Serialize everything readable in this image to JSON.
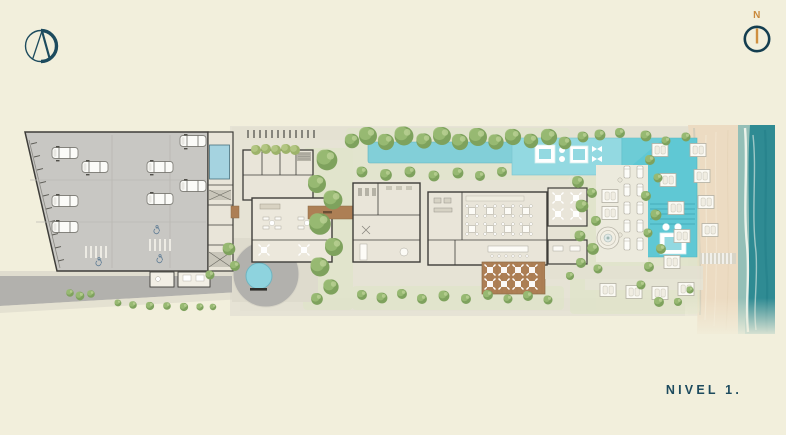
{
  "window": {
    "background_color": "#f2efdc"
  },
  "brand": {
    "monogram_letter": "A",
    "description": "circle-A-monogram-logo",
    "color": "#1d4b5e"
  },
  "compass": {
    "north_label": "N",
    "label_color": "#c9893b",
    "ring_color": "#143e50",
    "needle_color": "#cf8f3f"
  },
  "plan": {
    "level_label": "NIVEL 1.",
    "level_label_color": "#1d4b5e",
    "features": [
      "parking-garage",
      "access-road",
      "guard-house",
      "drop-off-court",
      "reflecting-pond",
      "lobby-building",
      "wellness-gym-building",
      "restaurant-building",
      "lounge-pavilions",
      "wood-dining-deck",
      "entry-bridge",
      "lap-pool",
      "family-pool",
      "main-pool",
      "pool-deck",
      "sun-loungers",
      "fountain",
      "gardens",
      "beach-cabanas",
      "boardwalk",
      "beach-sand",
      "ocean"
    ]
  },
  "palette": {
    "background": "#f2efdc",
    "navy": "#1d4b5e",
    "accent_orange": "#c9893b",
    "pool_teal": "#5fc8d4",
    "upper_pool": "#93d9e1",
    "lap_pool": "#82cfd8",
    "pond": "#8ed3de",
    "small_pool": "#a5d3e0",
    "ocean": "#2f8b93",
    "sand": "#ecdbc2",
    "garage": "#c8c7c3",
    "road": "#b2b1ad",
    "floor": "#e9e5d9",
    "wall": "#3e3d39",
    "wood_deck": "#ad7f55",
    "tree_green": "#7ea25d",
    "lawn": "#dfe5c8",
    "path": "#e3e0d2"
  }
}
